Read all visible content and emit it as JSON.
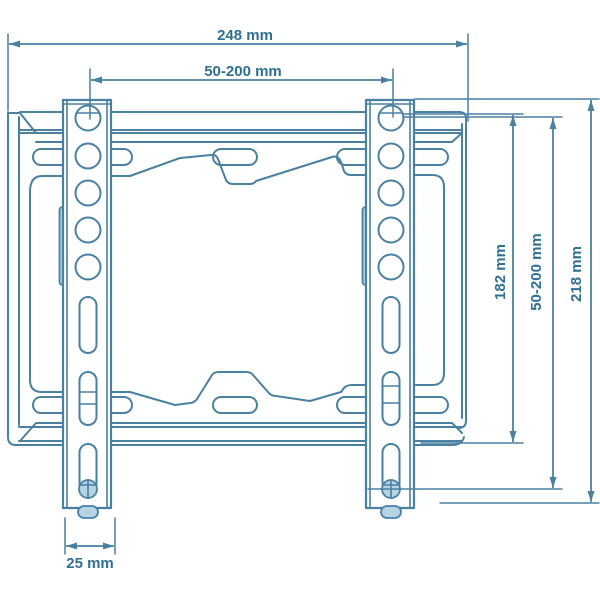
{
  "diagram": {
    "title": "TV wall mount bracket dimension drawing",
    "view": "front view line drawing",
    "colors": {
      "line": "#4a81a1",
      "text": "#2f6f91",
      "light_fill": "#b5d3e2",
      "background": "#ffffff"
    },
    "dimensions": {
      "total_width": "248 mm",
      "hole_spacing_horizontal": "50-200 mm",
      "bracket_height": "182 mm",
      "hole_spacing_vertical": "50-200 mm",
      "total_height": "218 mm",
      "rail_width": "25 mm"
    }
  }
}
